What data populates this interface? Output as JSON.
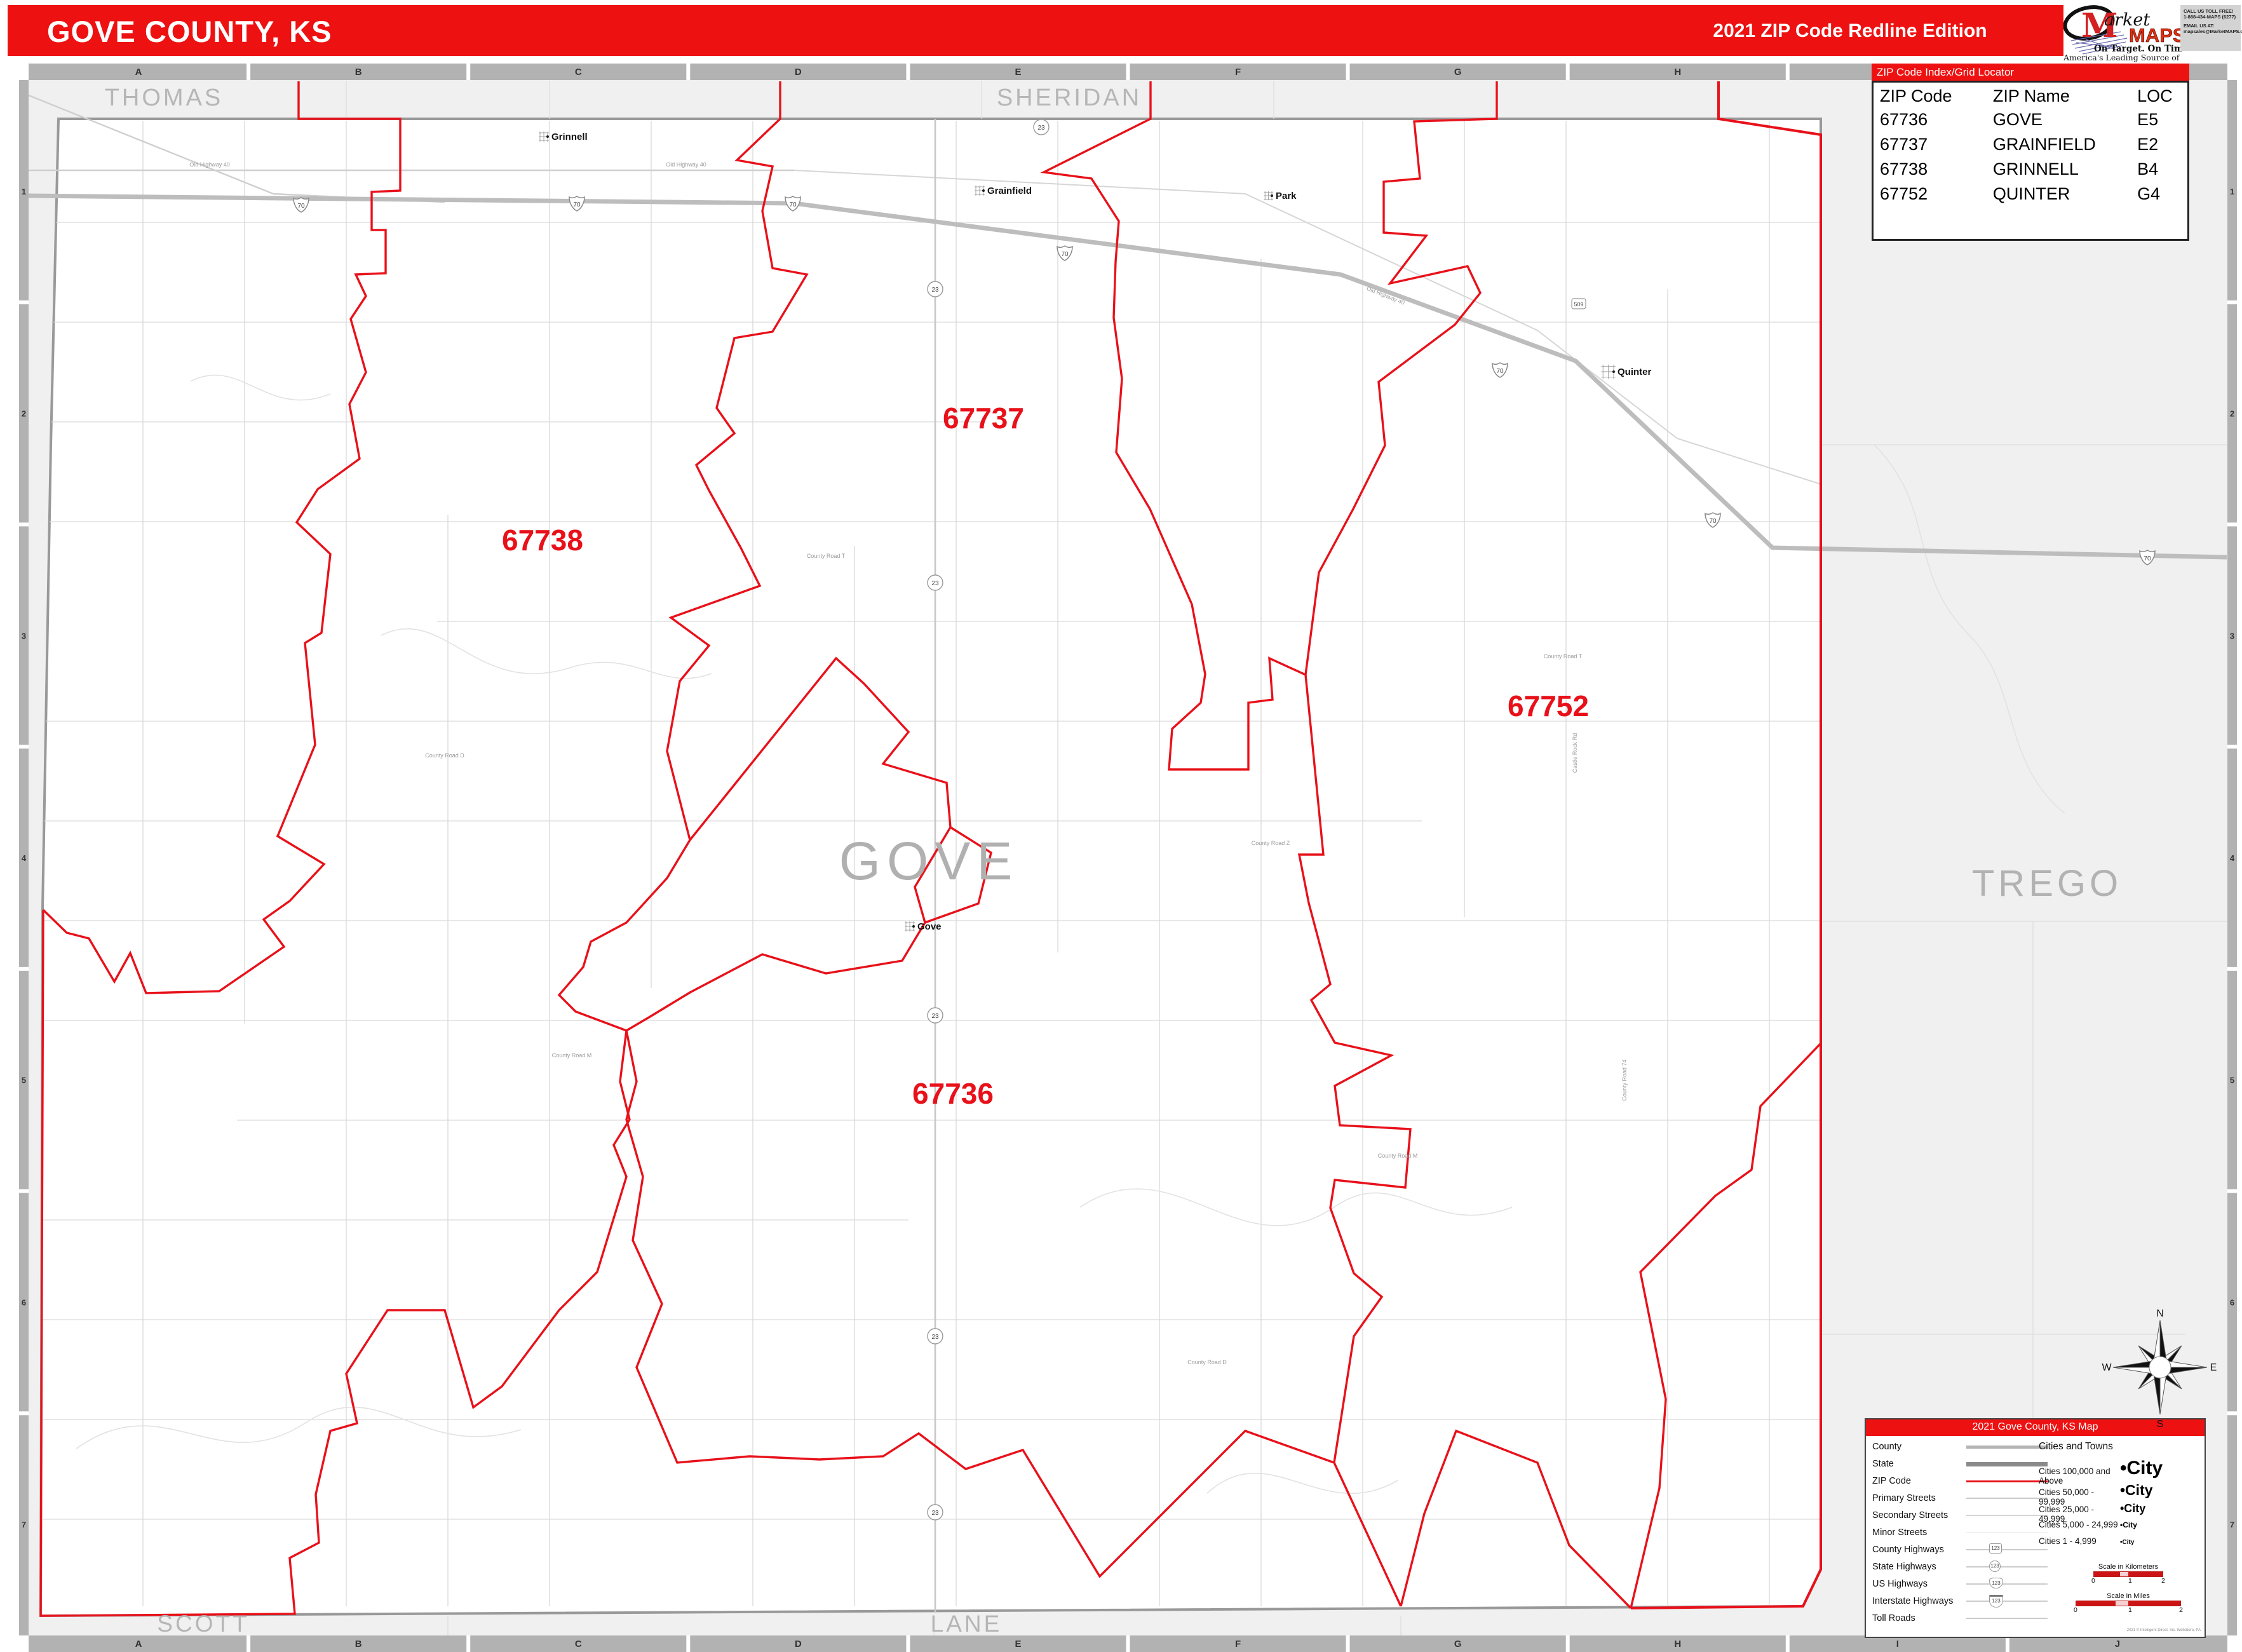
{
  "header": {
    "title": "GOVE COUNTY, KS",
    "edition": "2021 ZIP Code Redline Edition"
  },
  "logo": {
    "m": "M",
    "market": "arket",
    "maps": "MAPS",
    "tagline": "On Target.  On Time.",
    "subtitle": "America's Leading Source of Business Maps"
  },
  "contact": {
    "line1": "CALL US TOLL FREE!",
    "line2": "1-888-434-MAPS (6277)",
    "line3": "EMAIL US AT:",
    "line4": "mapsales@MarketMAPS.com"
  },
  "zip_index": {
    "title": "ZIP Code Index/Grid Locator",
    "columns": [
      "ZIP Code",
      "ZIP Name",
      "LOC"
    ],
    "rows": [
      {
        "zip": "67736",
        "name": "GOVE",
        "loc": "E5"
      },
      {
        "zip": "67737",
        "name": "GRAINFIELD",
        "loc": "E2"
      },
      {
        "zip": "67738",
        "name": "GRINNELL",
        "loc": "B4"
      },
      {
        "zip": "67752",
        "name": "QUINTER",
        "loc": "G4"
      }
    ]
  },
  "grid": {
    "letters": [
      "A",
      "B",
      "C",
      "D",
      "E",
      "F",
      "G",
      "H",
      "I",
      "J"
    ],
    "numbers": [
      "1",
      "2",
      "3",
      "4",
      "5",
      "6",
      "7"
    ]
  },
  "map": {
    "county_label": "GOVE",
    "neighbors": {
      "top_left": "THOMAS",
      "top": "SHERIDAN",
      "right": "TREGO",
      "bottom_left": "SCOTT",
      "bottom": "LANE"
    },
    "zip_labels": [
      {
        "code": "67738"
      },
      {
        "code": "67737"
      },
      {
        "code": "67736"
      },
      {
        "code": "67752"
      }
    ],
    "towns": [
      "Grinnell",
      "Grainfield",
      "Park",
      "Quinter",
      "Gove"
    ],
    "road_labels": [
      "Old Highway 40",
      "County Road D",
      "County Road T",
      "Castle Rock Rd",
      "County Road 74",
      "County Road M",
      "County Road Z"
    ],
    "shields": {
      "interstate": "70",
      "state": "23",
      "county": "509"
    },
    "colors": {
      "zip_line": "#e8111a",
      "county_line": "#999999",
      "neighbor_fill": "#f0f0f0"
    }
  },
  "legend": {
    "title": "2021 Gove County, KS Map",
    "line_items": [
      "County",
      "State",
      "ZIP Code",
      "Primary Streets",
      "Secondary Streets",
      "Minor Streets",
      "County Highways",
      "State Highways",
      "US Highways",
      "Interstate Highways",
      "Toll Roads"
    ],
    "shield_sample": "123",
    "cities_title": "Cities and Towns",
    "city_classes": [
      {
        "label": "Cities 100,000 and Above",
        "sample": "•City"
      },
      {
        "label": "Cities 50,000 - 99,999",
        "sample": "•City"
      },
      {
        "label": "Cities 25,000 - 49,999",
        "sample": "•City"
      },
      {
        "label": "Cities 5,000 - 24,999",
        "sample": "•City"
      },
      {
        "label": "Cities 1 - 4,999",
        "sample": "•City"
      }
    ],
    "scale_km": {
      "title": "Scale in Kilometers",
      "ticks": [
        "0",
        "1",
        "2"
      ]
    },
    "scale_mi": {
      "title": "Scale in Miles",
      "ticks": [
        "0",
        "1",
        "2"
      ]
    },
    "copyright": "2021 © Intelligent Direct, Inc.  Wellsboro, PA"
  },
  "compass": {
    "n": "N",
    "e": "E",
    "s": "S",
    "w": "W"
  }
}
